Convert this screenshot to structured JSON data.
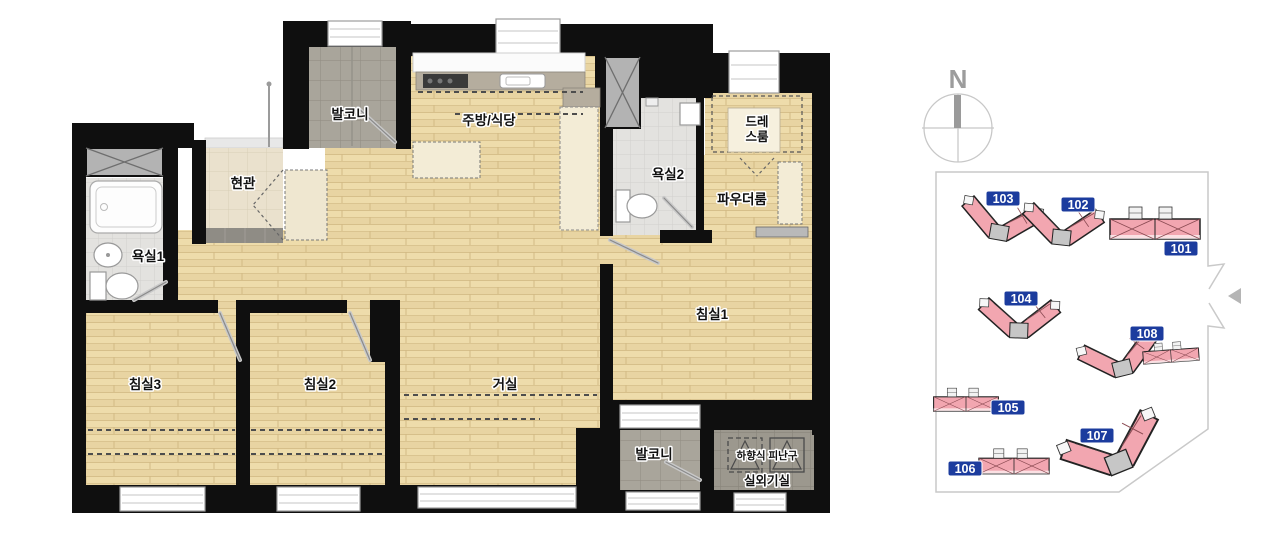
{
  "floorplan": {
    "rooms": {
      "balcony_top": "발코니",
      "kitchen_dining": "주방/식당",
      "entry": "현관",
      "bath1": "욕실1",
      "bath2": "욕실2",
      "dress_line1": "드레",
      "dress_line2": "스룸",
      "powder": "파우더룸",
      "bedroom1": "침실1",
      "bedroom2": "침실2",
      "bedroom3": "침실3",
      "living": "거실",
      "balcony_bottom": "발코니",
      "evac_hatch": "하향식 피난구",
      "outdoor_unit": "실외기실"
    }
  },
  "compass": {
    "north": "N"
  },
  "site_plan": {
    "buildings": [
      {
        "label": "101"
      },
      {
        "label": "102"
      },
      {
        "label": "103"
      },
      {
        "label": "104"
      },
      {
        "label": "105"
      },
      {
        "label": "106"
      },
      {
        "label": "107"
      },
      {
        "label": "108"
      }
    ],
    "badge_color": "#1c3c9e",
    "building_fill": "#f2a6b0",
    "boundary_color": "#c9c9c9"
  }
}
